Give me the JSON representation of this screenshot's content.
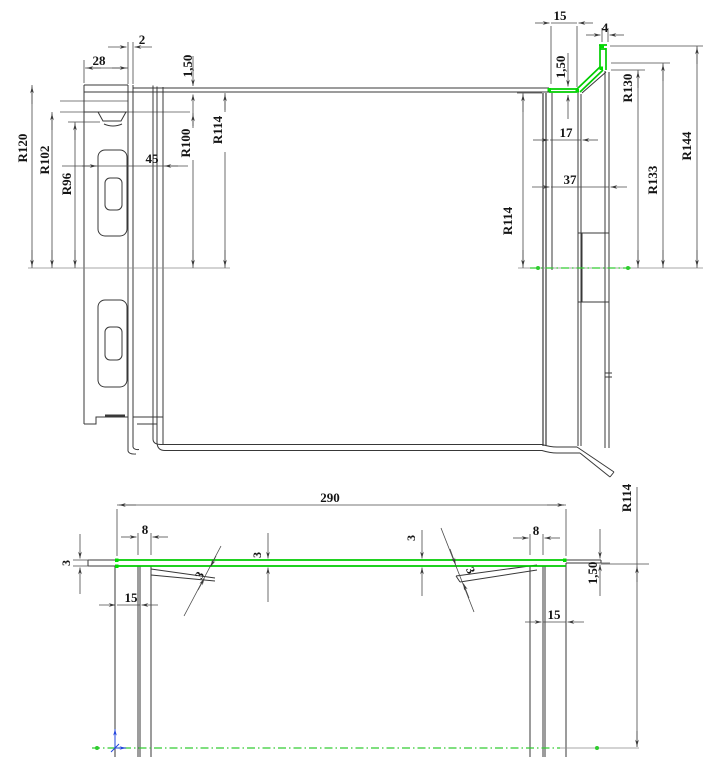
{
  "app": {
    "type": "cad-engineering-drawing",
    "background": "#ffffff"
  },
  "colors": {
    "geometry": "#383838",
    "dimension": "#4a4a4a",
    "highlight_selected_edges": "#00cc00",
    "centerline": "#33cc33",
    "origin_marker": "#2244dd"
  },
  "views": {
    "top": {
      "name": "section-view"
    },
    "bottom": {
      "name": "profile-view"
    }
  },
  "dims": {
    "t2": "2",
    "t28": "28",
    "t150l": "1,50",
    "tr120": "R120",
    "tr102": "R102",
    "tr96": "R96",
    "tr100": "R100",
    "tr114l": "R114",
    "t45": "45",
    "t15": "15",
    "t4": "4",
    "t150r": "1,50",
    "t17": "17",
    "t37": "37",
    "tr114m": "R114",
    "tr130": "R130",
    "tr133": "R133",
    "tr144": "R144",
    "b290": "290",
    "b8l": "8",
    "b8r": "8",
    "b3l": "3",
    "b3ml": "3",
    "b3mr": "3",
    "b3sl": "3",
    "b3sr": "3",
    "b15l": "15",
    "b15r": "15",
    "b150": "1,50",
    "br114": "R114"
  }
}
